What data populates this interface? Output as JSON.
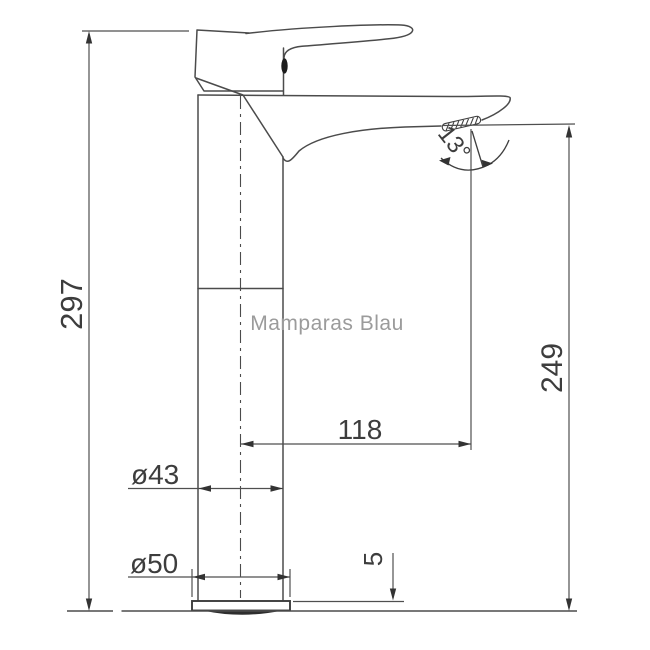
{
  "drawing": {
    "type": "technical-dimension-drawing",
    "subject": "tall single-lever basin mixer tap, side elevation",
    "background_color": "#ffffff",
    "line_color": "#4b4b4b",
    "dimension_line_color": "#4f4f4f",
    "text_color": "#3d3d3d",
    "dimensions": {
      "total_height": "297",
      "spout_tip_height": "249",
      "spout_reach": "118",
      "body_diameter": "ø43",
      "base_diameter": "ø50",
      "base_plate_height": "5",
      "spout_angle": "13°"
    },
    "watermark": {
      "text": "Mamparas Blau",
      "color": "#9b9b9b"
    }
  }
}
